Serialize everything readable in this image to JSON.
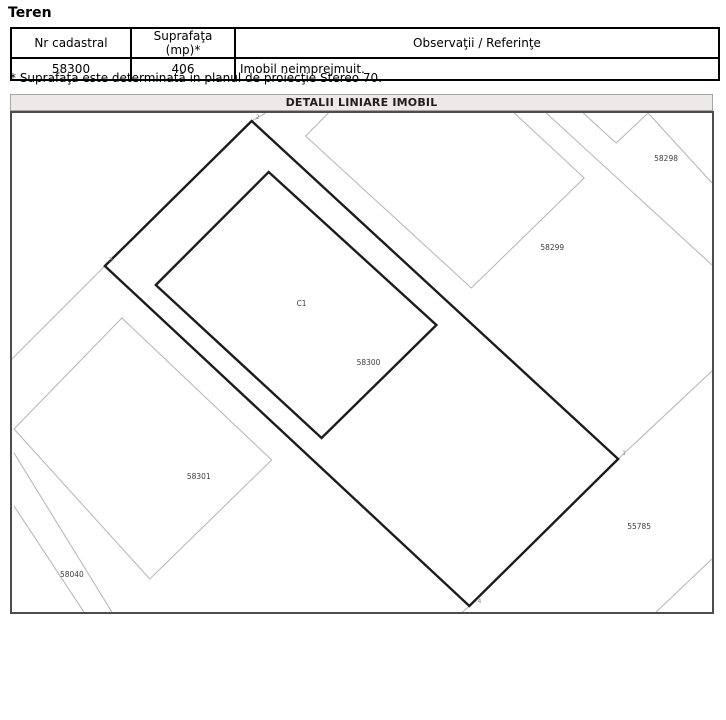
{
  "section_title": "Teren",
  "table": {
    "headers": [
      "Nr cadastral",
      "Suprafaţa (mp)*",
      "Observaţii / Referinţe"
    ],
    "row": {
      "nr_cadastral": "58300",
      "suprafata": "406",
      "observatii": "Imobil neimprejmuit."
    }
  },
  "footnote": "* Suprafaţa este determinată in planul de proiecţie Stereo 70.",
  "map": {
    "title": "DETALII LINIARE IMOBIL",
    "labels": {
      "parcel_58298": "58298",
      "parcel_58299": "58299",
      "building_c1": "C1",
      "parcel_58300": "58300",
      "parcel_58301": "58301",
      "parcel_58040": "58040",
      "parcel_55785": "55785"
    },
    "points": {
      "p1": "1",
      "p2": "2",
      "p3": "3",
      "p4": "4"
    },
    "colors": {
      "boundary_black": "#1c1c1c",
      "neighbor_gray": "#b9b9b9",
      "title_strip_bg": "#ece9e8",
      "map_border": "#4d4d4d"
    },
    "geometry": {
      "parcel_58300": "240,8 607,346 458,493 93,153",
      "building_c1": "257,59 425,212 310,325 144,172",
      "parcel_58299": "317,0 294,23 460,175 573,65 503,0",
      "parcel_58301": "110,205 260,347 138,466 2,316",
      "notch_v_58298": "572,0 605,30 637,0",
      "line_58298": "637,0 701,70",
      "line_58298_long": "535,0 701,152",
      "ext_point1": "607,346 701,258",
      "ext_point2": "240,8 254,0",
      "ext_point3": "93,153 0,246",
      "ext_point4": "458,493 448,502",
      "corner_bottom_right": "645,499 701,446",
      "road_58040_a": "2,340 100,499",
      "road_58040_b": "2,393 72,499"
    }
  }
}
